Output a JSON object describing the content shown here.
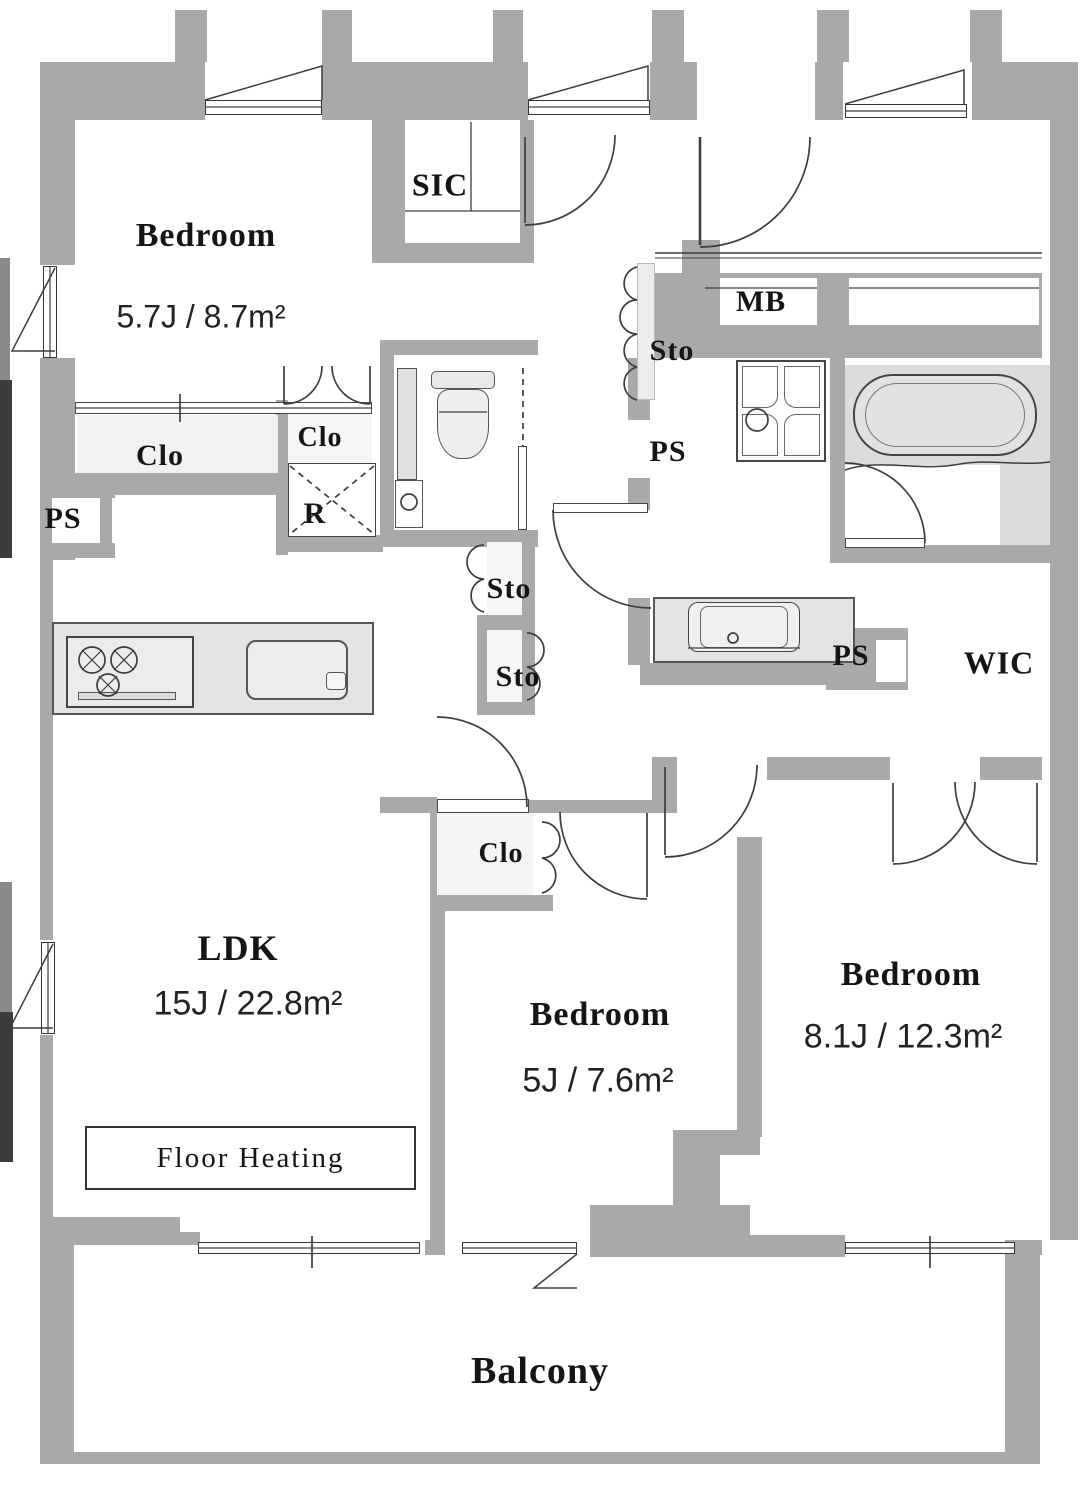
{
  "plan": {
    "rooms": [
      {
        "id": "bedroom1",
        "name": "Bedroom",
        "size": "5.7J / 8.7m²"
      },
      {
        "id": "ldk",
        "name": "LDK",
        "size": "15J / 22.8m²",
        "note": "Floor  Heating"
      },
      {
        "id": "bedroom2",
        "name": "Bedroom",
        "size": "5J / 7.6m²"
      },
      {
        "id": "bedroom3",
        "name": "Bedroom",
        "size": "8.1J / 12.3m²"
      },
      {
        "id": "balcony",
        "name": "Balcony"
      }
    ],
    "fixtures": {
      "shoe_in_closet": "SIC",
      "meter_box": "MB",
      "walk_in_closet": "WIC",
      "refrigerator_space": "R"
    },
    "storage_labels": [
      "Sto",
      "Sto",
      "Sto"
    ],
    "pipe_space_labels": [
      "PS",
      "PS",
      "PS"
    ],
    "closet_labels": [
      "Clo",
      "Clo",
      "Clo"
    ]
  },
  "colors": {
    "wall": "#a9a9a9",
    "floor": "#ffffff",
    "closet_fill": "#f2f2f2",
    "fixture_fill": "#e3e3e3",
    "tub_zone": "#dcdcdc",
    "line": "#3d3d3d",
    "text": "#151515"
  }
}
